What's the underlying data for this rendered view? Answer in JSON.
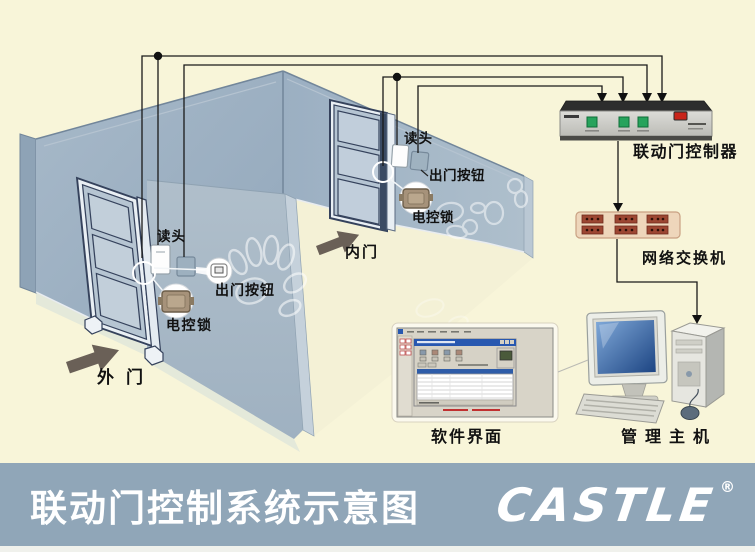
{
  "diagram": {
    "outer_door": {
      "door_label": "外门",
      "reader_label": "读头",
      "exit_button_label": "出门按钮",
      "lock_label": "电控锁"
    },
    "inner_door": {
      "door_label": "内门",
      "reader_label": "读头",
      "exit_button_label": "出门按钮",
      "lock_label": "电控锁"
    },
    "controller_label": "联动门控制器",
    "network_switch_label": "网络交换机",
    "software_label": "软件界面",
    "host_label": "管理主机"
  },
  "footer": {
    "title": "联动门控制系统示意图",
    "brand": "CASTLE",
    "registered": "®"
  },
  "colors": {
    "background": "#F8F5D9",
    "footer_bar": "#90A6B8",
    "wall": "#A2B5C5",
    "wall_edge": "#C5D1DB",
    "door_outline": "#35425C",
    "wire": "#1A1A1A",
    "direction_arrow": "#6A6057",
    "controller_button_green": "#27A35C",
    "controller_switch_red": "#C8241A",
    "switch_port": "#9C4632",
    "monitor_screen_blue": "#2E5FA3",
    "footer_text": "#FFFFFF"
  }
}
